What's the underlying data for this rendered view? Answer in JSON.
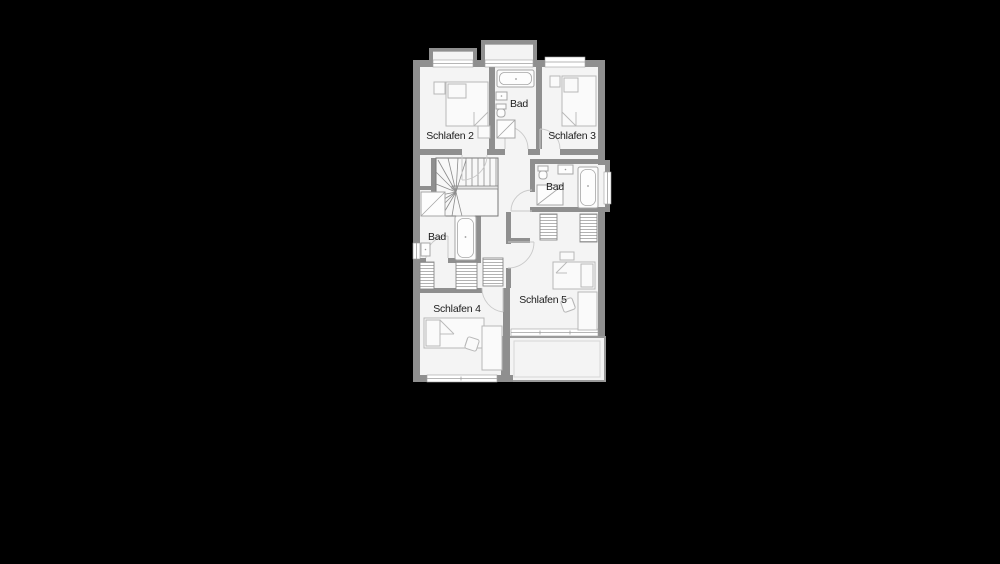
{
  "page": {
    "background": "#000000"
  },
  "floorplan": {
    "type": "floor-plan",
    "colors": {
      "background": "#000000",
      "wall": "#8f8f8f",
      "floor": "#f4f4f4",
      "fixture_line": "#a6a6a6",
      "furniture_line": "#b8b8b8",
      "door_arc": "#c9c9c9",
      "stair_line": "#8c8c8c",
      "window_line": "#9e9e9e",
      "railing": "#9a9a9a",
      "text": "#1c1c1c"
    },
    "rooms": [
      {
        "id": "schlafen-2",
        "label": "Schlafen 2"
      },
      {
        "id": "bad-top",
        "label": "Bad"
      },
      {
        "id": "schlafen-3",
        "label": "Schlafen 3"
      },
      {
        "id": "bad-mid-right",
        "label": "Bad"
      },
      {
        "id": "bad-mid-left",
        "label": "Bad"
      },
      {
        "id": "schlafen-4",
        "label": "Schlafen 4"
      },
      {
        "id": "schlafen-5",
        "label": "Schlafen 5"
      }
    ]
  }
}
